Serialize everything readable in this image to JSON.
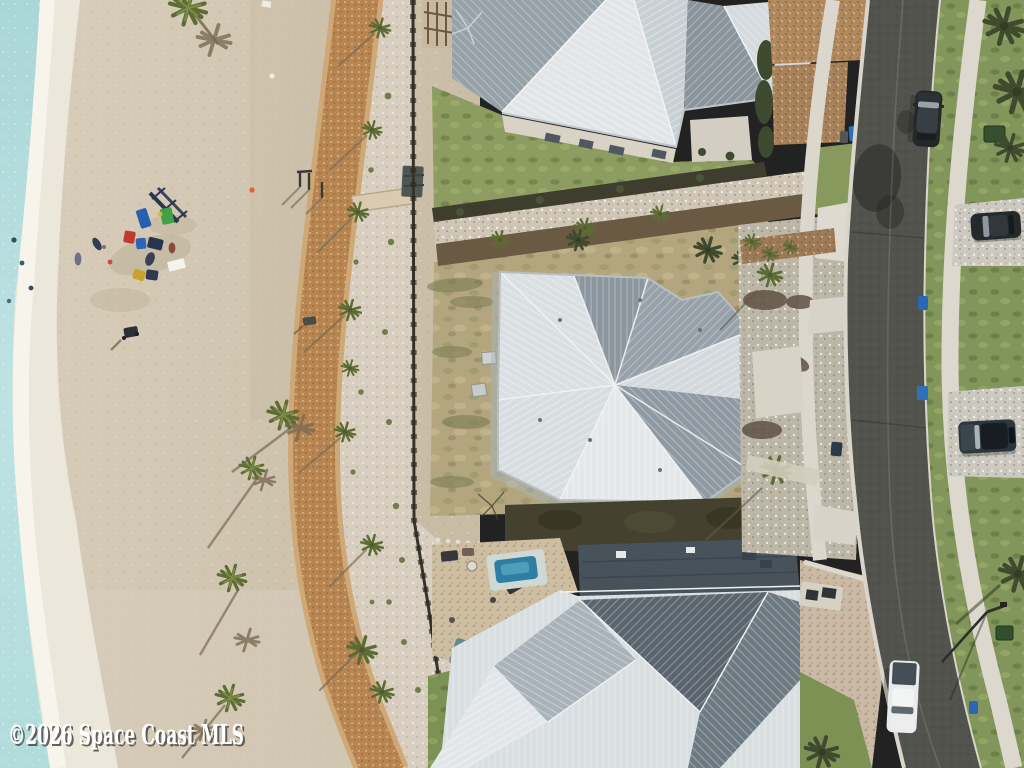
{
  "image": {
    "kind": "aerial-drone-photograph",
    "subject": "Aerial view of a beachfront vacant lot between metal-roof coastal homes, with beach, boardwalk path and residential street",
    "width_px": 1024,
    "height_px": 768
  },
  "watermark": {
    "text": "©2026 Space Coast MLS",
    "fill": "#ffffff",
    "shadow": "#4a4a44"
  },
  "palette": {
    "ocean_water": "#b4dcdd",
    "surf_foam": "#efeadf",
    "dry_sand": "#d0c5b0",
    "boardwalk_path": "#b78551",
    "dune_gravel": "#d7cec0",
    "scrub_lot": "#b3a67e",
    "lawn_green": "#8d9c60",
    "street_grass": "#82955a",
    "roof_bright": "#e2e5e7",
    "roof_light": "#ccd2d6",
    "roof_dark": "#8e98a1",
    "roof_darkest": "#5a656e",
    "flat_roof": "#47525a",
    "asphalt_road": "#53534e",
    "concrete_sidewalk": "#dbd7cc",
    "brown_pavers": "#b1895f",
    "shell_driveway": "#ccc9c1",
    "pool_water": "#2d7ea2",
    "recycle_bin_blue": "#2e6fb8",
    "palm_green": "#5d6b35",
    "palm_dark_green": "#3f4a2e",
    "vehicle_dark": "#24282b",
    "vehicle_white": "#e8ebea"
  },
  "scene": {
    "areas": [
      "ocean shoreline",
      "surf line",
      "sandy beach",
      "curved boardwalk path",
      "dune scrub strip",
      "vacant scrub lot",
      "front lawns",
      "hedge rows",
      "asphalt street",
      "concrete sidewalks",
      "paver driveways",
      "street-side grass"
    ],
    "buildings": [
      "top house with standing-seam metal roof",
      "center house with complex hip metal roof",
      "bottom house with metal roof, flat section and pool"
    ],
    "vehicles": [
      "black SUV driving on road",
      "dark car parked in shell driveway",
      "dark pickup parked in driveway",
      "white pickup driving on road"
    ],
    "landmarks": [
      "lifeguard access ramp",
      "beach chairs",
      "beach towels",
      "traffic cone",
      "palm trees with shadows",
      "blue trash bins",
      "street light",
      "utility boxes",
      "swimming pool",
      "pool equipment pads",
      "dumpster by path"
    ]
  }
}
